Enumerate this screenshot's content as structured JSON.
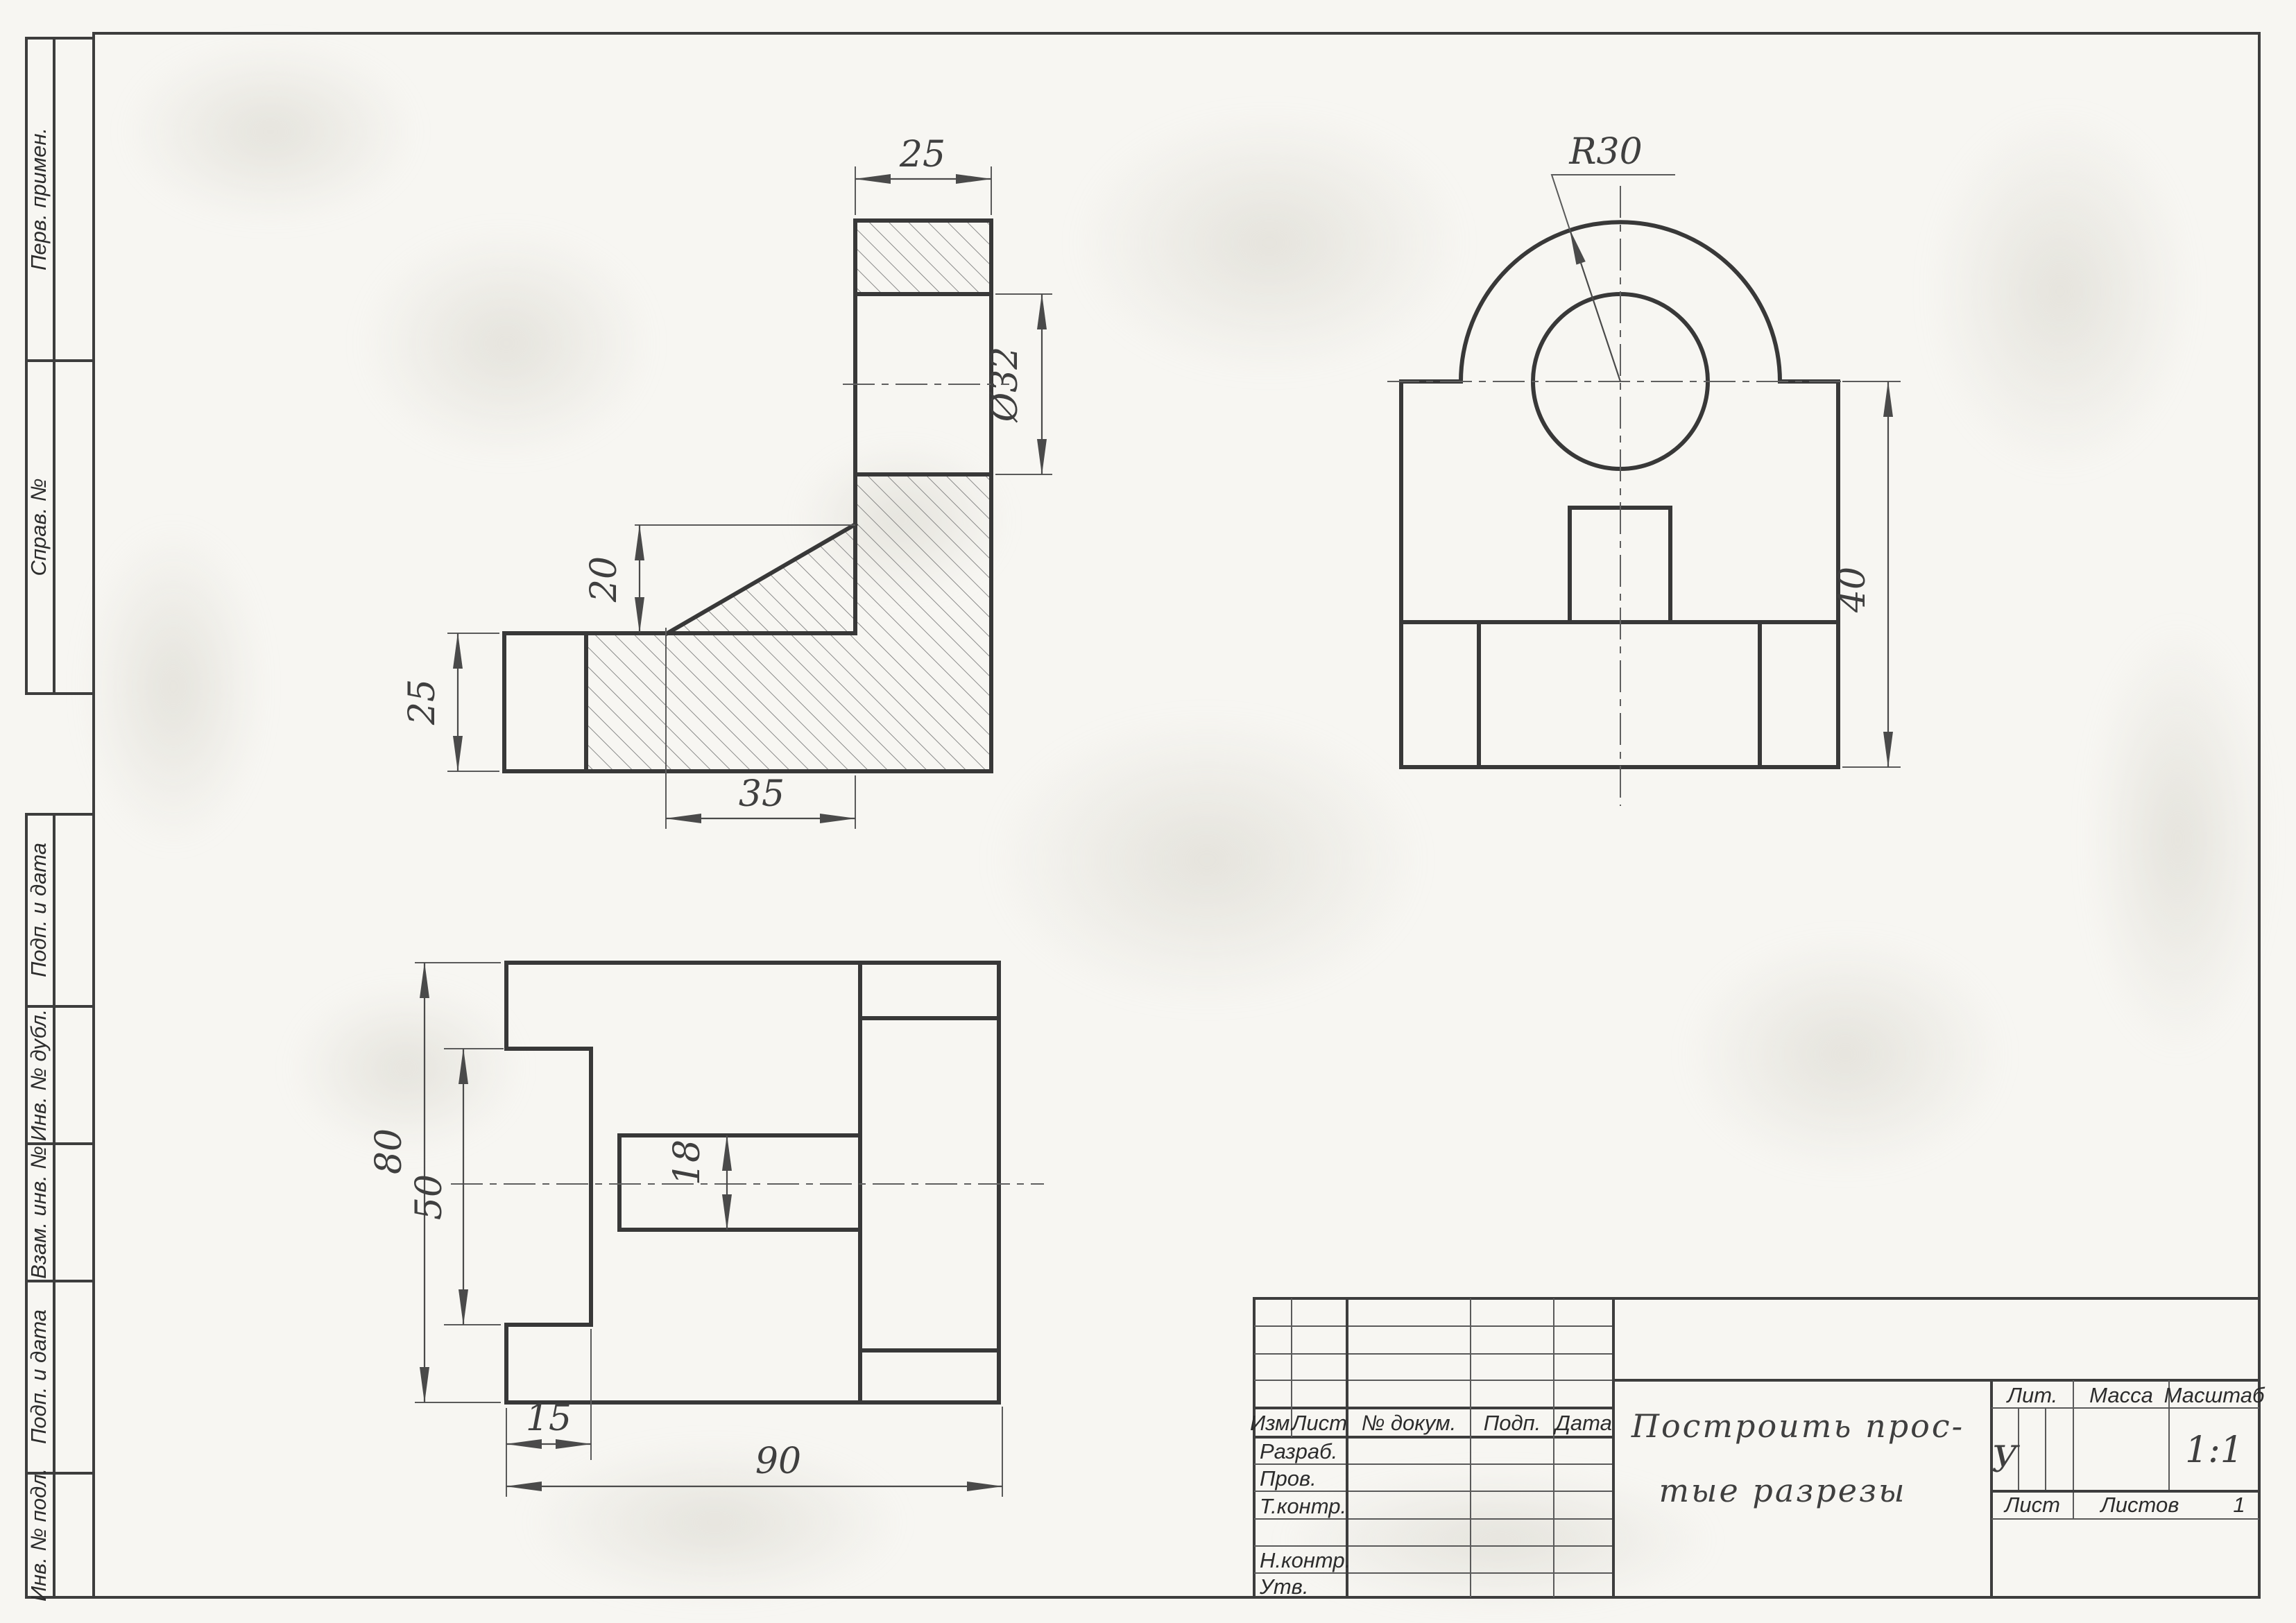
{
  "margin": {
    "labels": [
      "Перв. примен.",
      "Справ. №",
      "Подп. и дата",
      "Инв. № дубл.",
      "Взам. инв. №",
      "Подп. и дата",
      "Инв. № подл."
    ]
  },
  "dims": {
    "section": {
      "top_width": "25",
      "hole": "Ø32",
      "rib": "20",
      "base_h": "25",
      "base_l": "35"
    },
    "front": {
      "radius": "R30",
      "height": "40"
    },
    "plan": {
      "depth": "80",
      "notch": "50",
      "slot": "18",
      "tab": "15",
      "width": "90"
    }
  },
  "title_block": {
    "rev_cols": [
      "Изм.",
      "Лист",
      "№ докум.",
      "Подп.",
      "Дата"
    ],
    "roles": [
      "Разраб.",
      "Пров.",
      "Т.контр.",
      "Н.контр.",
      "Утв."
    ],
    "title_line1": "Построить прос-",
    "title_line2": "тые разрезы",
    "lit_label": "Лит.",
    "mass_label": "Масса",
    "scale_label": "Масштаб",
    "lit_value": "У",
    "scale_value": "1:1",
    "sheet_label": "Лист",
    "sheets_label": "Листов",
    "sheets_value": "1"
  }
}
